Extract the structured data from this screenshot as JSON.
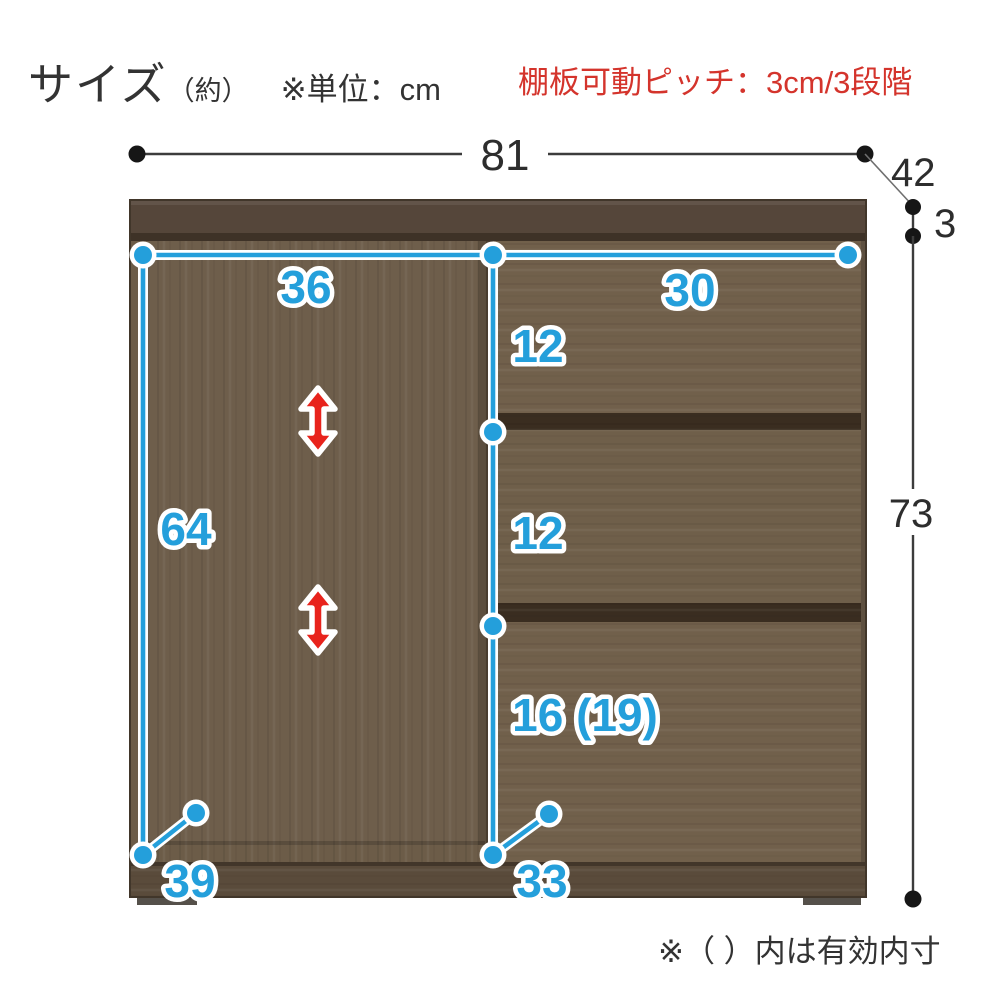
{
  "header": {
    "title": "サイズ",
    "approx": "（約）",
    "unit_note": "※単位：cm",
    "shelf_pitch_note": "棚板可動ピッチ：3cm/3段階"
  },
  "footnote": {
    "text": "※（ ）内は有効内寸"
  },
  "dims": {
    "overall_width": "81",
    "overall_depth": "42",
    "top_board_thickness": "3",
    "overall_height": "73",
    "door_inner_width": "36",
    "drawer_inner_width": "30",
    "drawer1_inner_height": "12",
    "drawer2_inner_height": "12",
    "drawer3_inner_height": "16 (19)",
    "door_inner_height": "64",
    "door_inner_depth": "39",
    "drawer_inner_depth": "33"
  },
  "colors": {
    "dimension_blue": "#249fdb",
    "shelf_arrow_red": "#e8231c",
    "note_red": "#d4342c",
    "annotation_black": "#2d2d2d",
    "wood_top_board": "#55463a",
    "wood_door": "#6e5e4b",
    "wood_drawer": "#71604b",
    "wood_gap": "#3a2d20",
    "wood_baseboard": "#5a4b3b"
  },
  "legend": {
    "unit": "cm",
    "shelf_pitch_cm": "3",
    "shelf_positions": "3"
  }
}
